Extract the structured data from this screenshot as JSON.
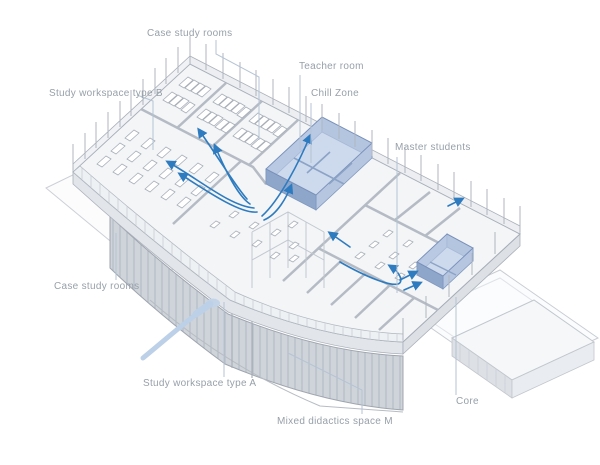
{
  "figure": {
    "type": "axonometric-floor-plan-diagram",
    "background": "#ffffff",
    "labels": [
      {
        "id": "case-study-rooms-top",
        "text": "Case study rooms"
      },
      {
        "id": "study-workspace-type-b",
        "text": "Study workspace type B"
      },
      {
        "id": "teacher-room",
        "text": "Teacher room"
      },
      {
        "id": "chill-zone",
        "text": "Chill Zone"
      },
      {
        "id": "master-students",
        "text": "Master students"
      },
      {
        "id": "case-study-rooms-left",
        "text": "Case study rooms"
      },
      {
        "id": "study-workspace-type-a",
        "text": "Study workspace type A"
      },
      {
        "id": "mixed-didactics-space-m",
        "text": "Mixed didactics space M"
      },
      {
        "id": "core",
        "text": "Core"
      }
    ],
    "highlighted_rooms": [
      "Teacher room / Chill Zone block",
      "Master students room"
    ],
    "colors": {
      "highlight_blue_wall": "#9fb4d6",
      "highlight_blue_floor": "#c9d6ea",
      "arrow_blue": "#2e7bbf",
      "entrance_arrow_blue": "#bcd0e8",
      "leader_line": "#b4c3d4",
      "label_text": "#97a0a9",
      "wall_gray": "#b5bbc4",
      "facade_gray": "#cfd4da"
    }
  }
}
